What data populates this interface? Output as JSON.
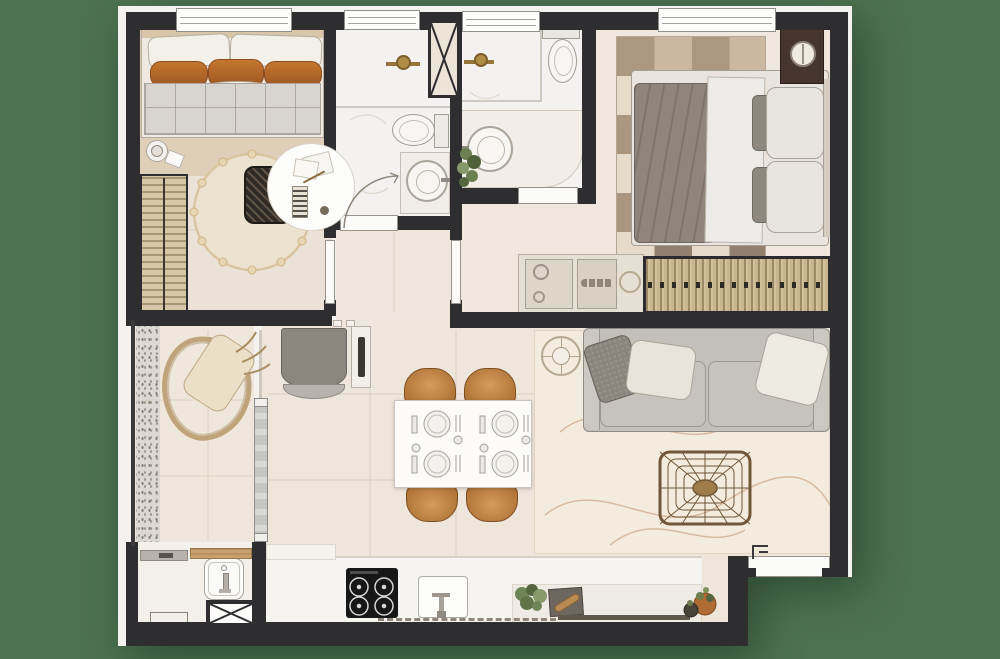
{
  "palette": {
    "background_green": "#4d7251",
    "plate_white": "#f4f2ee",
    "wall_dark": "#2e2e30",
    "floor_beige": "#eee5db",
    "floor_tan": "#e0cfb8",
    "bath_white": "#f4f2f0",
    "pillow_orange": "#bd702c",
    "chair_caramel": "#c28246",
    "brass": "#96743a",
    "sofa_gray": "#c3c0ba",
    "duvet_taupe": "#8f857b",
    "wicker_brown": "#7a5c38",
    "greenery": "#6c8052",
    "counter_white": "#f6f4f0",
    "rug_cream": "#f4ebdf"
  },
  "floor_plan": {
    "type": "apartment-top-view-render",
    "rooms": [
      {
        "name": "bedroom-1",
        "furniture": [
          "single-bed-orange-pillows",
          "quilted-blanket",
          "side-table-with-lamp",
          "wardrobe-open",
          "round-pompom-rug",
          "wicker-desk-chair",
          "desk-detail-circle"
        ]
      },
      {
        "name": "bathroom-1",
        "furniture": [
          "shower-brass-valve",
          "toilet",
          "round-basin-vanity",
          "swing-door"
        ]
      },
      {
        "name": "bathroom-2-ensuite",
        "furniture": [
          "shower-brass-valve",
          "toilet",
          "round-basin-counter",
          "plant",
          "door"
        ]
      },
      {
        "name": "master-bedroom",
        "furniture": [
          "double-bed",
          "geometric-triangle-rug",
          "dark-nightstand-round-lamp",
          "dresser-with-objects",
          "wardrobe-hangers"
        ]
      },
      {
        "name": "hallway",
        "furniture": [
          "door-to-bedroom-1",
          "door-to-master"
        ]
      },
      {
        "name": "balcony",
        "furniture": [
          "organic-lounge-chair",
          "sliding-glass-door",
          "pebble-strip",
          "railing"
        ]
      },
      {
        "name": "service-area",
        "furniture": [
          "laundry-tank-sink",
          "gray-shelf",
          "wood-plank",
          "floor-mat",
          "duct-shaft-x"
        ]
      },
      {
        "name": "kitchen",
        "furniture": [
          "cooktop-4-burners",
          "kitchen-sink",
          "herb-plant",
          "cutting-board-with-bread",
          "counter-island",
          "potted-plants",
          "dashed-upper-cabinet-line"
        ]
      },
      {
        "name": "living-dining",
        "furniture": [
          "gray-sofa-3-pillows",
          "round-glass-side-table",
          "rattan-web-coffee-table",
          "large-area-rug",
          "white-dining-table-4-settings",
          "caramel-dining-chairs-x4",
          "gray-console-with-tv-panel"
        ]
      }
    ],
    "features": {
      "windows": 4,
      "duct_shafts": 2,
      "entry_doors": 1,
      "dining_chairs": 4,
      "cooktop_burners": 4,
      "bedroom_doors": 2,
      "bathroom_doors": 2
    }
  }
}
